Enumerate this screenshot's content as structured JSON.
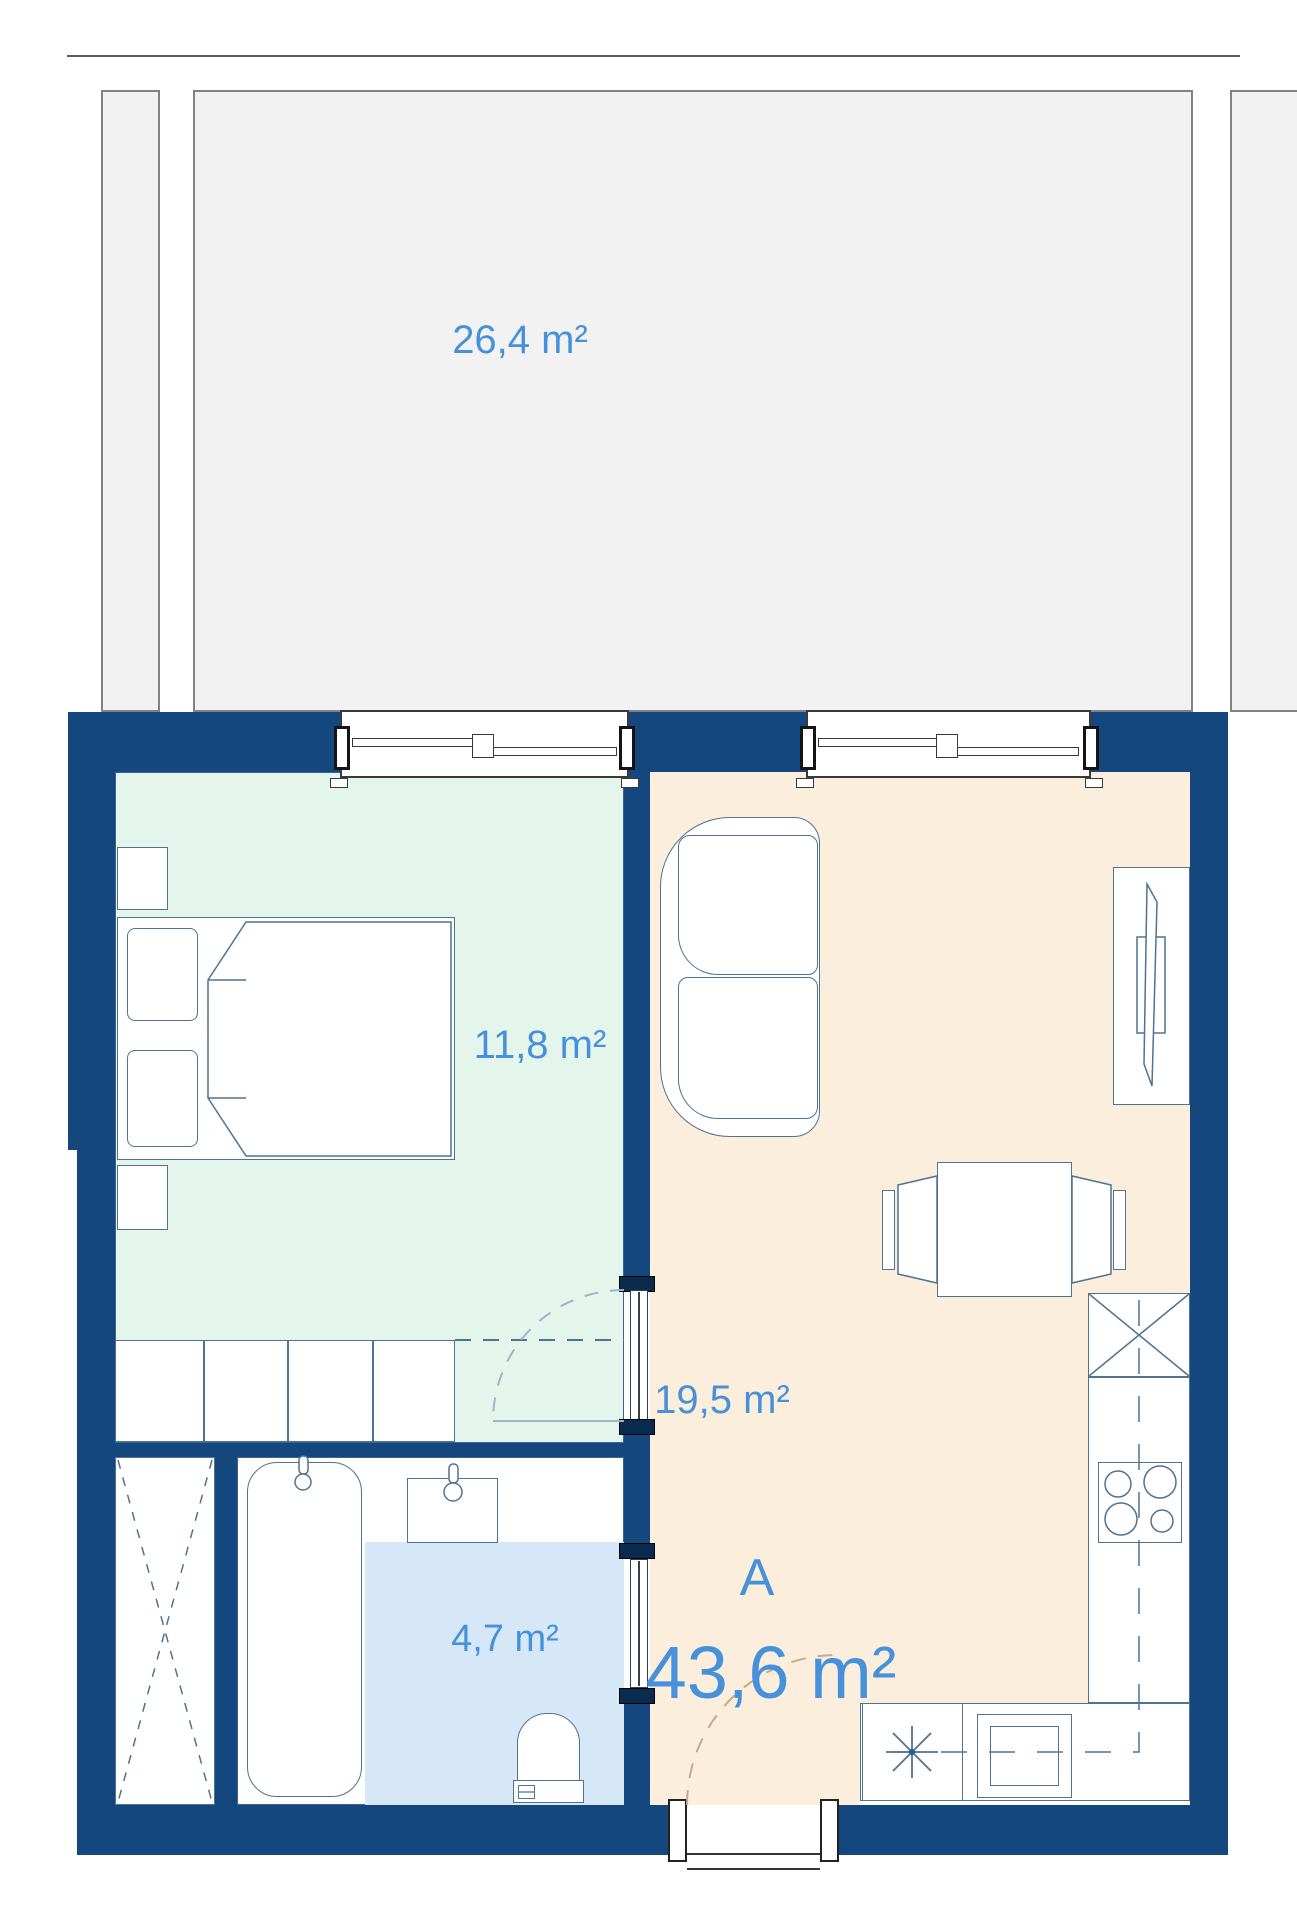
{
  "plan": {
    "terrace": {
      "area_label": "26,4 m²"
    },
    "bedroom": {
      "area_label": "11,8 m²"
    },
    "living_room": {
      "area_label": "19,5 m²"
    },
    "bathroom": {
      "area_label": "4,7 m²"
    },
    "unit": {
      "name_label": "A",
      "total_area_label": "43,6 m²"
    },
    "colors": {
      "wall": "#14477E",
      "bedroom_floor": "#E4F6EC",
      "living_floor": "#FCEEDD",
      "bathroom_floor": "#D6E8F8",
      "terrace_fill": "#F2F2F2",
      "label_text": "#4691DA",
      "furniture_outline": "#4F7391"
    }
  }
}
